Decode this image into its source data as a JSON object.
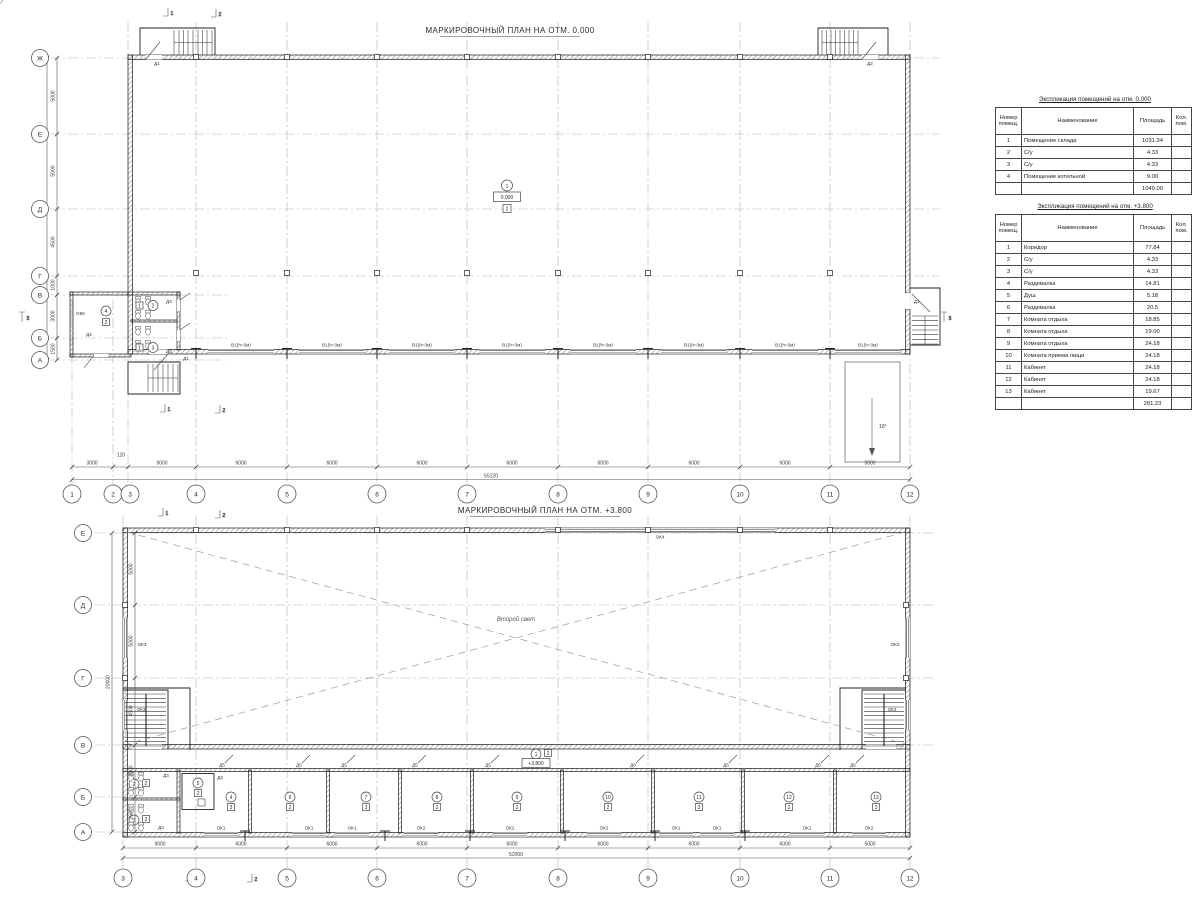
{
  "plan1": {
    "title": "МАРКИРОВОЧНЫЙ ПЛАН НА ОТМ. 0.000",
    "rowAxes": [
      "Ж",
      "Е",
      "Д",
      "Г",
      "В",
      "Б",
      "А"
    ],
    "rowDims": [
      "5000",
      "5000",
      "4500",
      "1000",
      "3000",
      "1500"
    ],
    "rowTotal": "20000",
    "colAxes": [
      "1",
      "2",
      "3",
      "4",
      "5",
      "6",
      "7",
      "8",
      "9",
      "10",
      "11",
      "12"
    ],
    "colDims": [
      "3000",
      "120",
      "9000",
      "6000",
      "6000",
      "6000",
      "6000",
      "6000",
      "6000",
      "6000",
      "5000"
    ],
    "colTotal": "55120",
    "windowStripLabel": "В1(h=3м)",
    "rampSlope": "10°",
    "levelTag": {
      "num": "1",
      "level": "0.000",
      "type": "2"
    },
    "boiler": {
      "num": "4",
      "type": "2",
      "window": "ОК5",
      "door": "Д4"
    },
    "wc1": {
      "num": "2",
      "type": "1",
      "door": "Д3"
    },
    "wc2": {
      "num": "3",
      "type": "1",
      "door": "Д3"
    },
    "doors": {
      "d1": "Д1",
      "d2": "Д2"
    },
    "sections": {
      "s1": "1",
      "s2": "2",
      "s3": "3"
    }
  },
  "plan2": {
    "title": "МАРКИРОВОЧНЫЙ ПЛАН НА ОТМ. +3.800",
    "rowAxes": [
      "Е",
      "Д",
      "Г",
      "В",
      "Б",
      "А"
    ],
    "rowDims": [
      "5000",
      "5000",
      "4500",
      "3000",
      "2500"
    ],
    "rowTotal": "20000",
    "colAxes": [
      "3",
      "4",
      "5",
      "6",
      "7",
      "8",
      "9",
      "10",
      "11",
      "12"
    ],
    "colDims": [
      "9000",
      "6000",
      "6000",
      "6000",
      "6000",
      "6000",
      "6000",
      "6000",
      "5000"
    ],
    "colTotal": "52000",
    "secondLight": "Второй свет",
    "corridorTag": {
      "num": "1",
      "level": "+3.800",
      "type": "2"
    },
    "okLabels": {
      "ok3": "ОК3",
      "ok4": "ОК4"
    },
    "bottomWindows": [
      "ОК1",
      "ОК1",
      "ОК1",
      "ОК2",
      "ОК2",
      "ОК2",
      "ОК1",
      "ОК1",
      "ОК1",
      "ОК2"
    ],
    "doorLabels": [
      "Д5",
      "Д5",
      "Д5",
      "Д5",
      "Д5",
      "Д6",
      "Д6",
      "Д6",
      "Д6"
    ],
    "wcDoor": "Д3",
    "showerDoor": "Д3",
    "rooms": [
      {
        "num": "2",
        "type": "2"
      },
      {
        "num": "3",
        "type": "2"
      },
      {
        "num": "4",
        "type": "3"
      },
      {
        "num": "5",
        "type": "2"
      },
      {
        "num": "6",
        "type": "2"
      },
      {
        "num": "7",
        "type": "3"
      },
      {
        "num": "8",
        "type": "2"
      },
      {
        "num": "9",
        "type": "2"
      },
      {
        "num": "10",
        "type": "2"
      },
      {
        "num": "11",
        "type": "3"
      },
      {
        "num": "12",
        "type": "2"
      },
      {
        "num": "13",
        "type": "3"
      }
    ],
    "sections": {
      "s1": "1",
      "s2": "2"
    }
  },
  "tables": [
    {
      "title": "Экспликация помещений на отм. 0.000",
      "headers": {
        "num": "Номер помещ.",
        "name": "Наименование",
        "area": "Площадь",
        "count": "Кол. пом."
      },
      "rows": [
        {
          "num": "1",
          "name": "Помещение склада",
          "area": "1031.34"
        },
        {
          "num": "2",
          "name": "С/у",
          "area": "4.33"
        },
        {
          "num": "3",
          "name": "С/у",
          "area": "4.33"
        },
        {
          "num": "4",
          "name": "Помещение котельной",
          "area": "9.00"
        }
      ],
      "total": "1049.00"
    },
    {
      "title": "Экспликация помещений на отм. +3.800",
      "headers": {
        "num": "Номер помещ.",
        "name": "Наименование",
        "area": "Площадь",
        "count": "Кол. пом."
      },
      "rows": [
        {
          "num": "1",
          "name": "Коридор",
          "area": "77.84"
        },
        {
          "num": "2",
          "name": "С/у",
          "area": "4.33"
        },
        {
          "num": "3",
          "name": "С/у",
          "area": "4.33"
        },
        {
          "num": "4",
          "name": "Раздевалка",
          "area": "14.81"
        },
        {
          "num": "5",
          "name": "Душ",
          "area": "5.18"
        },
        {
          "num": "6",
          "name": "Раздевалка",
          "area": "20.5"
        },
        {
          "num": "7",
          "name": "Комната отдыха",
          "area": "18.85"
        },
        {
          "num": "8",
          "name": "Комната отдыха",
          "area": "19.00"
        },
        {
          "num": "9",
          "name": "Комната отдыха",
          "area": "24.18"
        },
        {
          "num": "10",
          "name": "Комната приема пищи",
          "area": "24.18"
        },
        {
          "num": "11",
          "name": "Кабинет",
          "area": "24.18"
        },
        {
          "num": "12",
          "name": "Кабинет",
          "area": "24.18"
        },
        {
          "num": "13",
          "name": "Кабинет",
          "area": "19.67"
        }
      ],
      "total": "281.23"
    }
  ]
}
